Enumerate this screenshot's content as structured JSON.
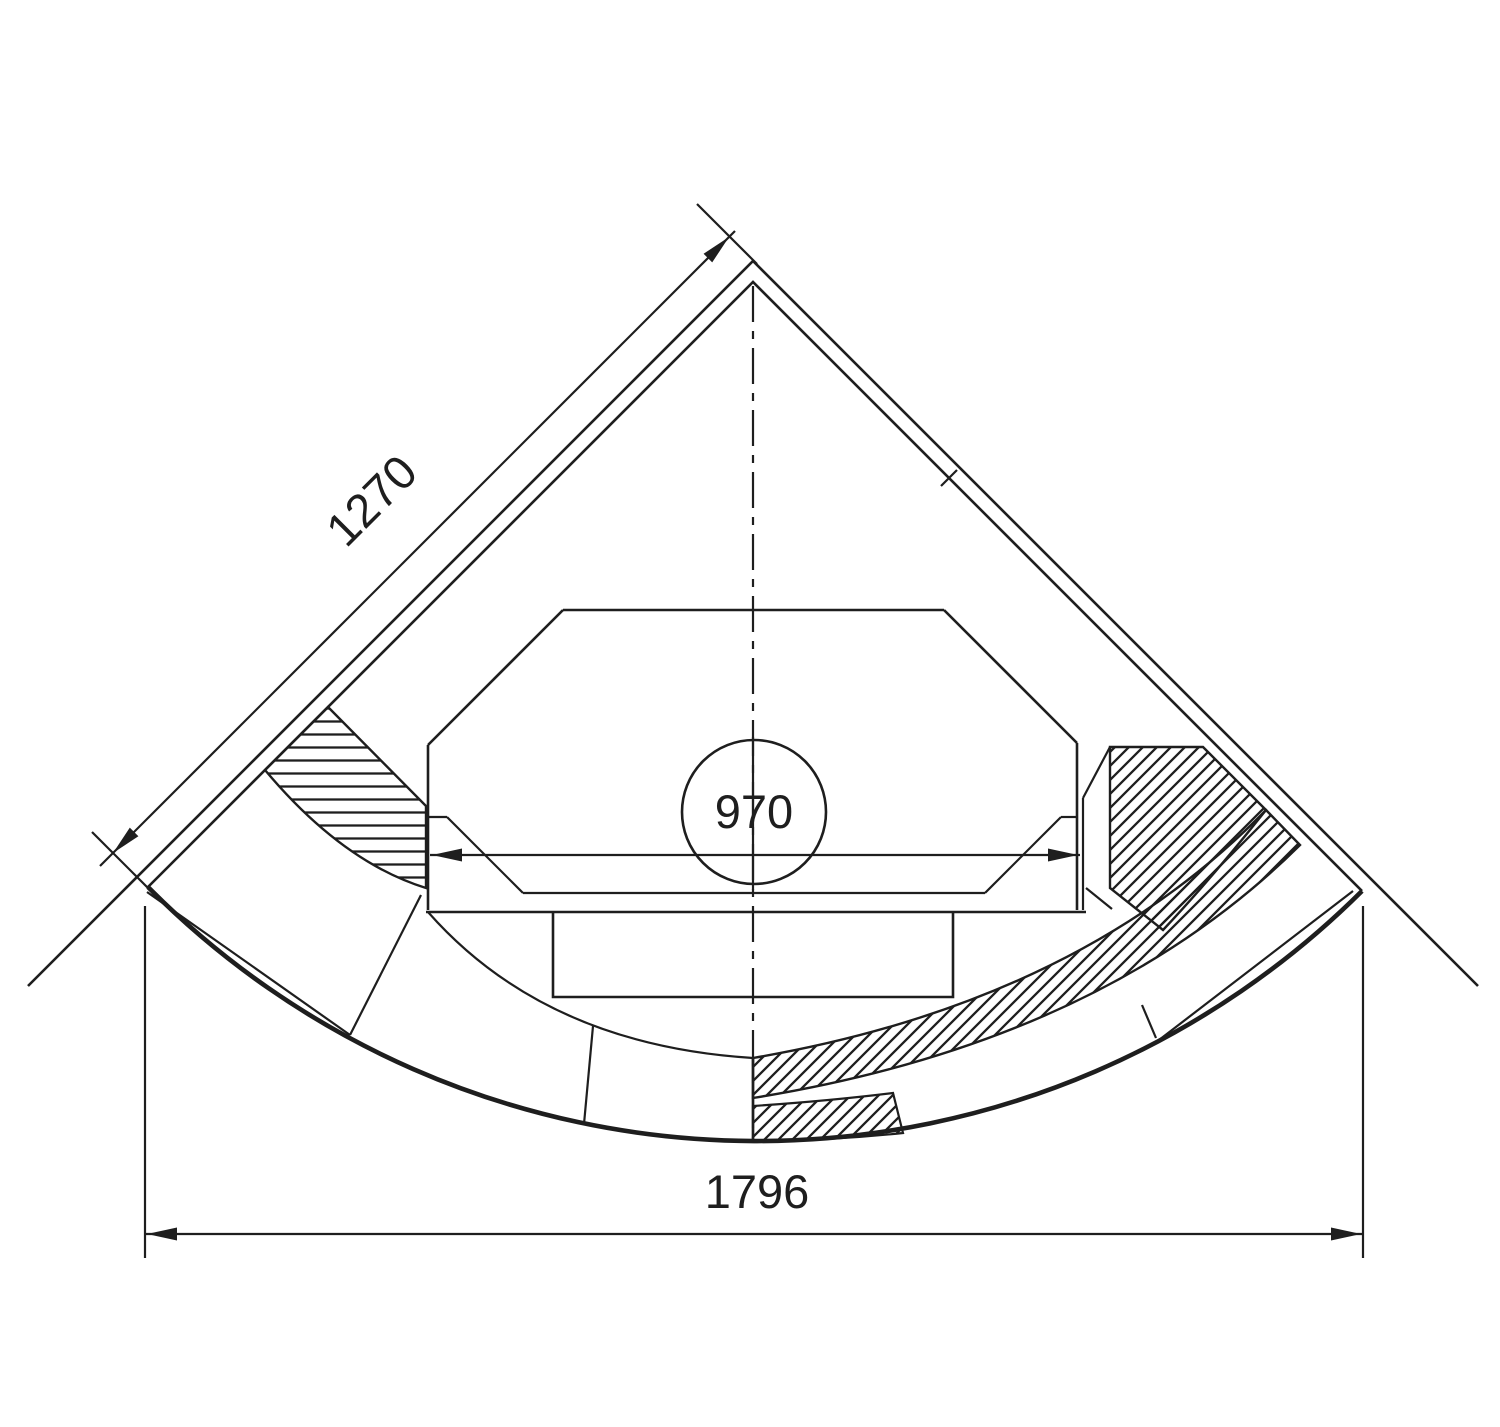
{
  "page": {
    "background_color": "#ffffff"
  },
  "drawing": {
    "stroke_color": "#1e1e1e",
    "dimensions": {
      "side_wall_length": {
        "value": "1270"
      },
      "firebox_opening_width": {
        "value": "970"
      },
      "overall_front_width": {
        "value": "1796"
      }
    }
  }
}
